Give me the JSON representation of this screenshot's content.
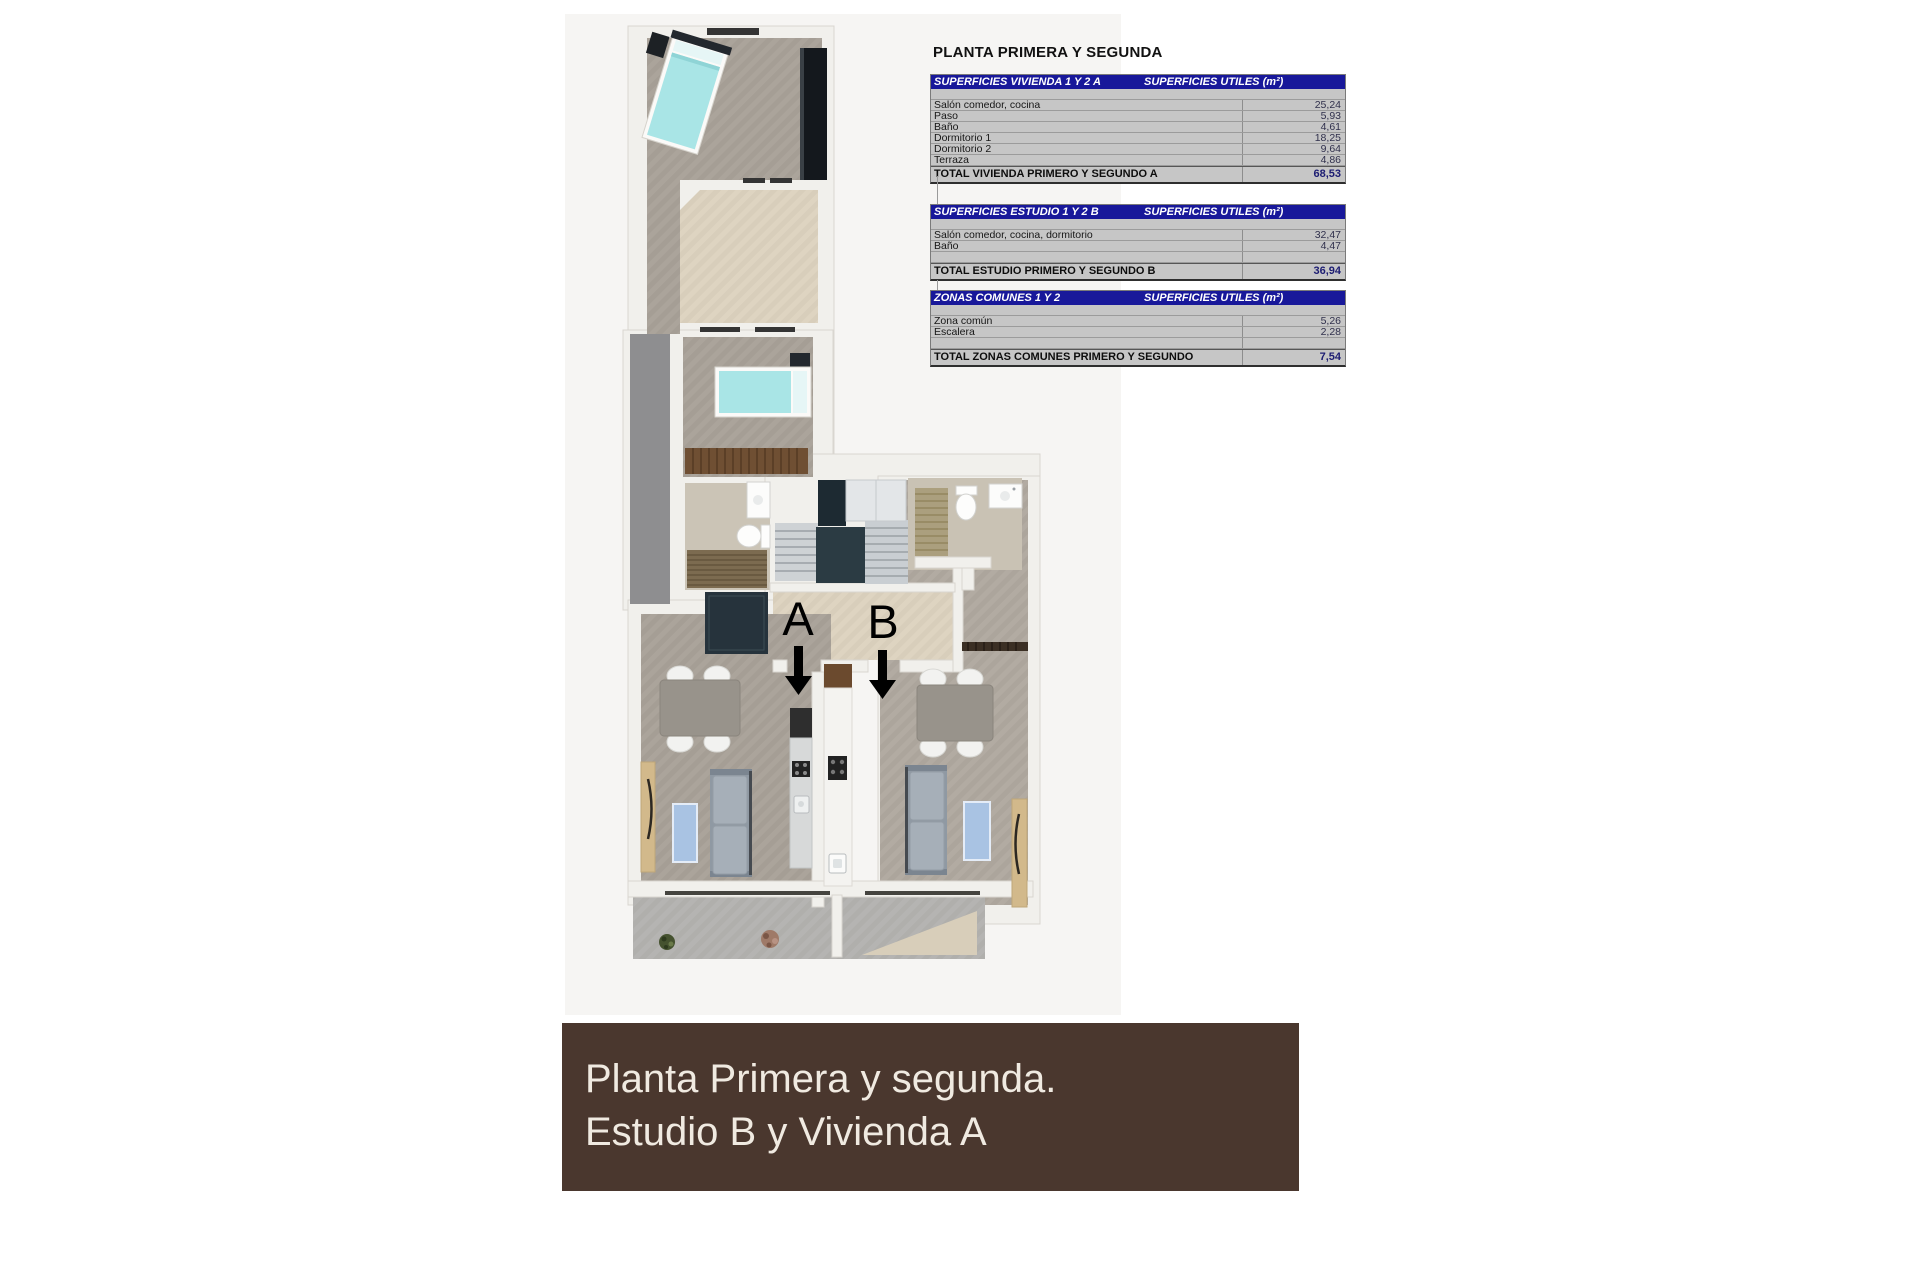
{
  "header": {
    "title": "PLANTA PRIMERA Y SEGUNDA"
  },
  "tables": [
    {
      "title": "SUPERFICIES VIVIENDA 1 Y 2 A",
      "unit_header": "SUPERFICIES UTILES  (m²)",
      "rows": [
        {
          "label": "Salón comedor, cocina",
          "value": "25,24"
        },
        {
          "label": "Paso",
          "value": "5,93"
        },
        {
          "label": "Baño",
          "value": "4,61"
        },
        {
          "label": "Dormitorio 1",
          "value": "18,25"
        },
        {
          "label": "Dormitorio 2",
          "value": "9,64"
        },
        {
          "label": "Terraza",
          "value": "4,86"
        }
      ],
      "total": {
        "label": "TOTAL VIVIENDA PRIMERO Y SEGUNDO A",
        "value": "68,53"
      }
    },
    {
      "title": "SUPERFICIES ESTUDIO 1 Y 2 B",
      "unit_header": "SUPERFICIES UTILES  (m²)",
      "rows": [
        {
          "label": "Salón comedor, cocina, dormitorio",
          "value": "32,47"
        },
        {
          "label": "Baño",
          "value": "4,47"
        }
      ],
      "total": {
        "label": "TOTAL ESTUDIO PRIMERO Y SEGUNDO B",
        "value": "36,94"
      }
    },
    {
      "title": "ZONAS COMUNES 1 Y 2",
      "unit_header": "SUPERFICIES UTILES  (m²)",
      "rows": [
        {
          "label": "Zona común",
          "value": "5,26"
        },
        {
          "label": "Escalera",
          "value": "2,28"
        }
      ],
      "total": {
        "label": "TOTAL ZONAS COMUNES PRIMERO Y SEGUNDO",
        "value": "7,54"
      }
    }
  ],
  "plan": {
    "label_a": "A",
    "label_b": "B"
  },
  "caption": {
    "line1": "Planta Primera y segunda.",
    "line2": "Estudio B y Vivienda A"
  },
  "colors": {
    "table_header": "#18189a",
    "caption_brown": "#4a372e",
    "bed_teal": "#a9e5e6"
  }
}
